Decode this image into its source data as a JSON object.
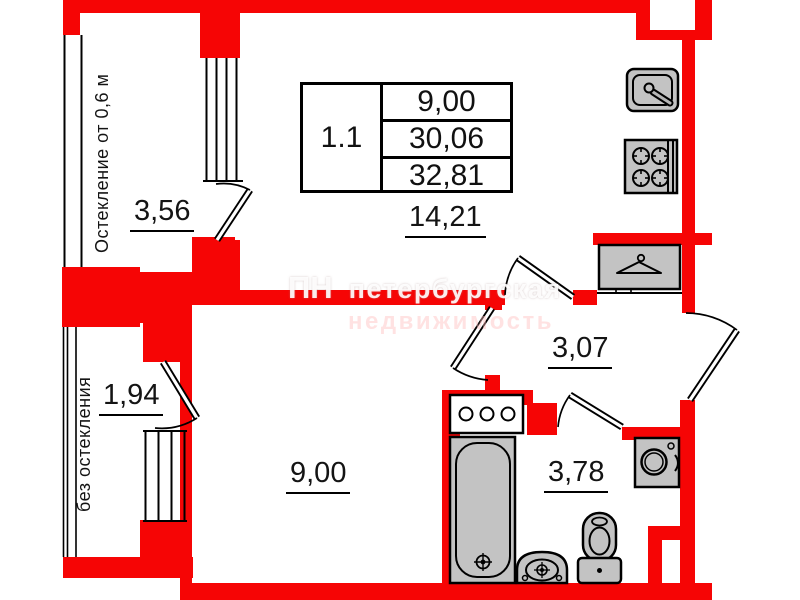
{
  "colors": {
    "wall": "#f60505",
    "fixture_fill": "#c3c3c3",
    "line": "#000000"
  },
  "title_block": {
    "unit_number": "1.1",
    "living_area": "9,00",
    "apartment_area": "30,06",
    "total_area": "32,81"
  },
  "rooms": {
    "main_room_area": "14,21",
    "bedroom_area": "9,00",
    "hall_area": "3,07",
    "bathroom_area": "3,78",
    "balcony_top_area": "3,56",
    "balcony_bottom_area": "1,94"
  },
  "notes": {
    "balcony_top": "Остекление от 0,6 м",
    "balcony_bottom": "без остекления"
  },
  "watermark": {
    "logo": "ПН",
    "line1": "петербургская",
    "line2": "недвижимость"
  },
  "fixtures": [
    "kitchen-sink-icon",
    "stove-icon",
    "wardrobe-icon",
    "bath-vanity-icon",
    "bathtub-icon",
    "washbasin-icon",
    "toilet-icon",
    "washing-machine-icon"
  ]
}
